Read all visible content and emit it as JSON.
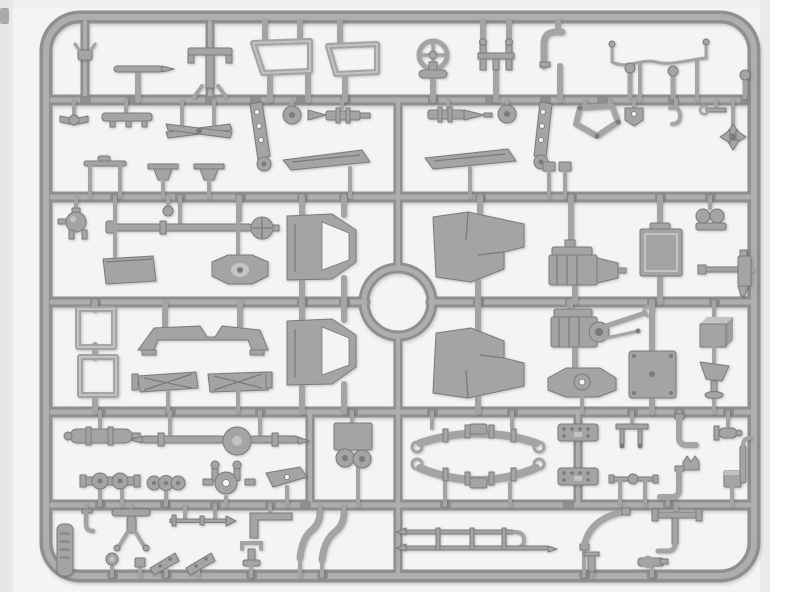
{
  "scene": {
    "description": "Photograph of a gray injection-molded plastic model kit sprue filled with small truck parts on a white background",
    "subject": "plastic-model-sprue",
    "orientation": "landscape"
  },
  "colors": {
    "page_bg": "#ffffff",
    "photo_bg": "#f4f4f2",
    "photo_edge": "#e7e7e5",
    "photo_top": "#efefed",
    "photo_shadow": "#eaeae8",
    "corner_mark": "#a9a9a9",
    "plastic": "#a4a4a4",
    "plastic_dark": "#7b7b7b",
    "plastic_light": "#c3c3c3",
    "runner_dark": "#8f8f8f",
    "runner_light": "#aeaeae",
    "nub": "#8a8a8a"
  },
  "sprue": {
    "frame": {
      "x": 46,
      "y": 17,
      "width": 708,
      "height": 559,
      "corner_radius": 34,
      "bar_thickness": 13
    },
    "horizontal_runners_y": [
      100,
      197,
      302,
      412,
      505
    ],
    "center_ring": {
      "cx": 398,
      "cy": 302,
      "radius": 34
    },
    "molded_label_tag": {
      "present": true,
      "text_legible": false,
      "position": "bottom-left"
    }
  },
  "parts": [
    "hood-clamp",
    "wiper-blade",
    "roof-bow",
    "windscreen-frame-1",
    "windscreen-frame-2",
    "steering-wheel",
    "seat-frame",
    "grab-handle",
    "brake-line-harness",
    "gear-lever-1",
    "gear-lever-2",
    "corner-pin",
    "wing-toggle",
    "finned-bar",
    "ski-cross-member",
    "control-lever-left",
    "wheel-disc-1",
    "gun-cradle-left",
    "spring-blade-left",
    "anvil-bracket-1",
    "anvil-bracket-2",
    "grip-rod",
    "gun-cradle-right",
    "wheel-disc-2",
    "control-lever-right",
    "pentagon-bracket",
    "foot-bracket",
    "small-hook",
    "wrench-head",
    "fan-cross",
    "spring-blade-right",
    "bracket-pair",
    "ball-joint",
    "mini-disc",
    "torque-tube",
    "floor-plate",
    "boss-plate",
    "cab-door-1",
    "front-fender-1",
    "engine-block-1",
    "radiator",
    "twin-cylinder",
    "machine-gun",
    "stowage-frame-1",
    "stowage-frame-2",
    "cross-member-arch",
    "tapered-cover-1",
    "tapered-cover-2",
    "cab-door-2",
    "front-fender-2",
    "engine-block-2",
    "engine-mount",
    "brake-drum-backplate",
    "stowage-box",
    "funnel-seat",
    "muffler",
    "front-axle",
    "drive-coupling",
    "gear-cluster",
    "steering-knuckle",
    "wing-blade",
    "pedal-box",
    "leaf-spring-1",
    "leaf-spring-2",
    "rivet-plate-1",
    "rivet-plate-2",
    "table-bracket",
    "elbow-pipe-1",
    "flanged-cylinder",
    "crown-bracket",
    "elbow-pipe-2",
    "small-cube",
    "rod-with-knob",
    "frame-pipe",
    "bottom-hook",
    "trestle-stand",
    "arrow-rod",
    "l-bracket",
    "u-handle",
    "lamp",
    "small-bolt",
    "mudflap-1",
    "mudflap-2",
    "exhaust-pipe-1",
    "exhaust-pipe-2",
    "exhaust-ladder",
    "curved-pipe",
    "pipe-tee",
    "valve",
    "short-pipe",
    "molded-label-tag"
  ]
}
